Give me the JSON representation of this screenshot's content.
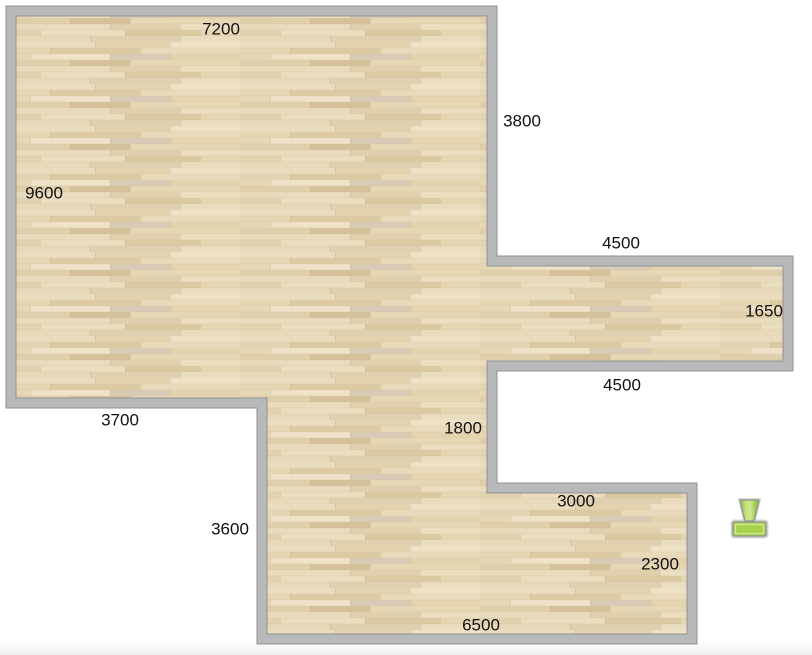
{
  "colors": {
    "background": "#ffffff",
    "bottom_fade": "#efefef",
    "wall_fill": "#b8b9bb",
    "wall_edge": "#919191",
    "floor_base": "#e7d9ba",
    "label_color": "#111111",
    "furniture_green": "#a7d14d",
    "furniture_green_light": "#cdea8d",
    "furniture_outline": "#909090"
  },
  "icons": {
    "furniture_item": "chair-top-view-icon"
  },
  "plan": {
    "labels": [
      {
        "id": "top-wall",
        "text": "7200"
      },
      {
        "id": "upper-right-wall",
        "text": "3800"
      },
      {
        "id": "left-wall",
        "text": "9600"
      },
      {
        "id": "right-ext-top-wall",
        "text": "4500"
      },
      {
        "id": "right-ext-right-wall",
        "text": "1650"
      },
      {
        "id": "right-ext-bottom-wall",
        "text": "4500"
      },
      {
        "id": "lower-left-wall",
        "text": "3700"
      },
      {
        "id": "middle-wall",
        "text": "1800"
      },
      {
        "id": "bottom-ext-top-wall",
        "text": "3000"
      },
      {
        "id": "bottom-left-wall",
        "text": "3600"
      },
      {
        "id": "bottom-ext-right-wall",
        "text": "2300"
      },
      {
        "id": "bottom-wall",
        "text": "6500"
      }
    ]
  }
}
